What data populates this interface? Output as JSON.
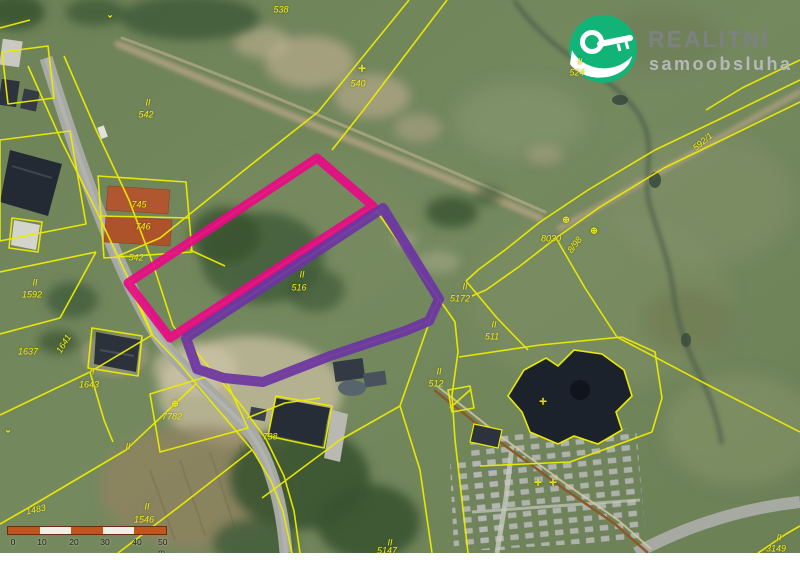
{
  "brand": {
    "name": "REALITNÍ",
    "subtitle": "samoobsluha",
    "icon": "key-in-hand-icon",
    "circle_color": "#12b377",
    "name_color": "#7e8184",
    "subtitle_color": "#b9bcbe"
  },
  "map": {
    "type": "cadastral-aerial-map",
    "colors": {
      "parcel_line_yellow": "#ecec00",
      "highlight_pink": "#e60a84",
      "highlight_purple": "#6b34a4",
      "label_yellow": "#f2ef14"
    },
    "parcel_labels": [
      {
        "text": "538",
        "x": 281,
        "y": 10
      },
      {
        "text": "II",
        "x": 148,
        "y": 103
      },
      {
        "text": "542",
        "x": 146,
        "y": 115
      },
      {
        "text": "540",
        "x": 358,
        "y": 84
      },
      {
        "text": "II",
        "x": 580,
        "y": 62
      },
      {
        "text": "524",
        "x": 577,
        "y": 73
      },
      {
        "text": "592/1",
        "x": 703,
        "y": 142,
        "rot": -40
      },
      {
        "text": "8030",
        "x": 551,
        "y": 239
      },
      {
        "text": "8/98",
        "x": 575,
        "y": 245,
        "rot": -52
      },
      {
        "text": "II",
        "x": 465,
        "y": 287
      },
      {
        "text": "5172",
        "x": 460,
        "y": 299
      },
      {
        "text": "II",
        "x": 494,
        "y": 325
      },
      {
        "text": "511",
        "x": 492,
        "y": 337
      },
      {
        "text": "II",
        "x": 439,
        "y": 372
      },
      {
        "text": "512",
        "x": 436,
        "y": 384
      },
      {
        "text": "II",
        "x": 302,
        "y": 275
      },
      {
        "text": "516",
        "x": 299,
        "y": 288
      },
      {
        "text": "745",
        "x": 139,
        "y": 205
      },
      {
        "text": "746",
        "x": 143,
        "y": 227
      },
      {
        "text": "542",
        "x": 136,
        "y": 258
      },
      {
        "text": "II",
        "x": 35,
        "y": 283
      },
      {
        "text": "1592",
        "x": 32,
        "y": 295
      },
      {
        "text": "1637",
        "x": 28,
        "y": 352
      },
      {
        "text": "1641",
        "x": 64,
        "y": 344,
        "rot": -58
      },
      {
        "text": "II",
        "x": 92,
        "y": 372
      },
      {
        "text": "1643",
        "x": 89,
        "y": 385
      },
      {
        "text": "7782",
        "x": 172,
        "y": 417
      },
      {
        "text": "738",
        "x": 270,
        "y": 437
      },
      {
        "text": "II",
        "x": 128,
        "y": 447
      },
      {
        "text": "II",
        "x": 147,
        "y": 507
      },
      {
        "text": "1546",
        "x": 144,
        "y": 520
      },
      {
        "text": "1483",
        "x": 36,
        "y": 510,
        "rot": -12
      },
      {
        "text": "II",
        "x": 390,
        "y": 543
      },
      {
        "text": "5147",
        "x": 387,
        "y": 551
      },
      {
        "text": "II",
        "x": 779,
        "y": 538
      },
      {
        "text": "3149",
        "x": 776,
        "y": 549
      }
    ],
    "symbols": [
      {
        "glyph": "⌄",
        "x": 110,
        "y": 15,
        "name": "boundary-mark"
      },
      {
        "glyph": "✛",
        "x": 362,
        "y": 69,
        "name": "boundary-mark"
      },
      {
        "glyph": "⊕",
        "x": 566,
        "y": 220,
        "name": "land-use-mark"
      },
      {
        "glyph": "⊕",
        "x": 594,
        "y": 231,
        "name": "land-use-mark"
      },
      {
        "glyph": "⊕",
        "x": 175,
        "y": 404,
        "name": "land-use-mark"
      },
      {
        "glyph": "✛",
        "x": 543,
        "y": 402,
        "name": "church-cross-mark"
      },
      {
        "glyph": "✛",
        "x": 538,
        "y": 483,
        "name": "church-cross-mark"
      },
      {
        "glyph": "✛",
        "x": 553,
        "y": 483,
        "name": "church-cross-mark"
      },
      {
        "glyph": "⌄",
        "x": 8,
        "y": 430,
        "name": "boundary-mark"
      }
    ]
  },
  "scalebar": {
    "border_color": "#6b2d12",
    "segment_colors": [
      "#c2551e",
      "#f2efe6",
      "#c2551e",
      "#f2efe6",
      "#c2551e"
    ],
    "ticks": [
      {
        "label": "0",
        "x": 7
      },
      {
        "label": "10",
        "x": 36
      },
      {
        "label": "20",
        "x": 68
      },
      {
        "label": "30",
        "x": 99
      },
      {
        "label": "40",
        "x": 131
      },
      {
        "label": "50 m",
        "x": 158
      }
    ]
  }
}
